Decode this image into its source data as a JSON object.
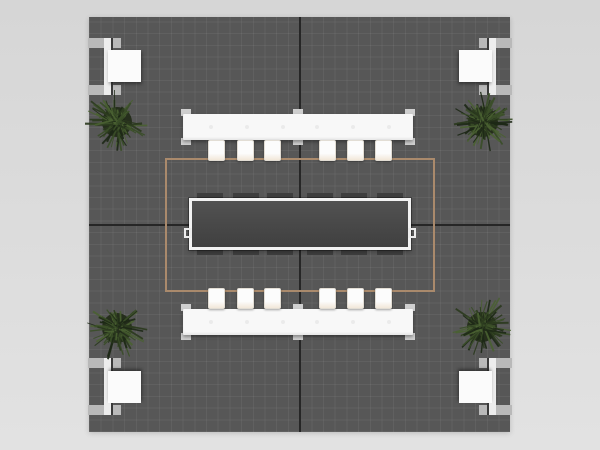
{
  "scene": {
    "description": "top-down-render-of-square-exhibit-booth-floor-plan",
    "background_top": "#d6d6d6",
    "background_bottom": "#e2e2e2",
    "floor": {
      "x": 89,
      "y": 17,
      "w": 421,
      "h": 415,
      "color": "#575757",
      "grid_line_color": "rgba(255,255,255,0.055)",
      "grid_size": 11.7,
      "seam_color": "#262626",
      "seam_x": 299,
      "seam_y": 224
    },
    "rug_outline": {
      "x": 76,
      "y": 141,
      "w": 270,
      "h": 134,
      "line_color": "#aa8a6c",
      "line_width": 2
    },
    "conference_table": {
      "x": 100,
      "y": 181,
      "w": 222,
      "h": 52,
      "top_color": "#474747",
      "border_color": "#f2f2f2",
      "grommet_color": "#ececec",
      "chair_mark_color": "#3e3e3e",
      "chair_marks_x": [
        8,
        44,
        78,
        118,
        152,
        188
      ]
    },
    "counter_style": {
      "w": 230,
      "h": 26,
      "color": "#f8f8f8",
      "tab_color": "#cfcfcf",
      "dot_color": "#ebebeb",
      "tabs_x": [
        -2,
        110,
        222
      ],
      "dots_x": [
        26,
        62,
        98,
        132,
        168,
        204
      ]
    },
    "counters": [
      {
        "id": "counter-top",
        "x": 94,
        "y": 97,
        "stool_y": 123,
        "stools_x": [
          119,
          148,
          175,
          230,
          258,
          286
        ]
      },
      {
        "id": "counter-bottom",
        "x": 94,
        "y": 292,
        "stool_y": 271,
        "stools_x": [
          119,
          148,
          175,
          230,
          258,
          286
        ]
      }
    ],
    "stool_style": {
      "w": 17,
      "h": 21,
      "color": "#fcfcfc",
      "cushion_color": "#f2e7d9",
      "edge_color": "#e2ddd4"
    },
    "corner_unit_style": {
      "w": 43,
      "h": 57,
      "flange_color": "#b9b9b9",
      "web_color": "#ededed",
      "web_line_color": "#3a3a3a",
      "cabinet_color": "#fbfbfb"
    },
    "corner_units": [
      {
        "id": "corner-unit-top-left",
        "x": -1,
        "y": 21,
        "flip_x": false,
        "flip_y": false
      },
      {
        "id": "corner-unit-top-right",
        "x": 380,
        "y": 21,
        "flip_x": true,
        "flip_y": false
      },
      {
        "id": "corner-unit-bottom-left",
        "x": -1,
        "y": 341,
        "flip_x": false,
        "flip_y": true
      },
      {
        "id": "corner-unit-bottom-right",
        "x": 380,
        "y": 341,
        "flip_x": true,
        "flip_y": true
      }
    ],
    "plants": [
      {
        "id": "plant-top-left",
        "cx": 28,
        "cy": 105
      },
      {
        "id": "plant-top-right",
        "cx": 394,
        "cy": 105
      },
      {
        "id": "plant-bottom-left",
        "cx": 28,
        "cy": 311
      },
      {
        "id": "plant-bottom-right",
        "cx": 393,
        "cy": 310
      }
    ],
    "plant_style": {
      "radius": 32,
      "base_color": "#202a16",
      "foliage_palette": [
        "#1d2816",
        "#2b3a1e",
        "#3a4e28",
        "#4a6132"
      ]
    }
  }
}
